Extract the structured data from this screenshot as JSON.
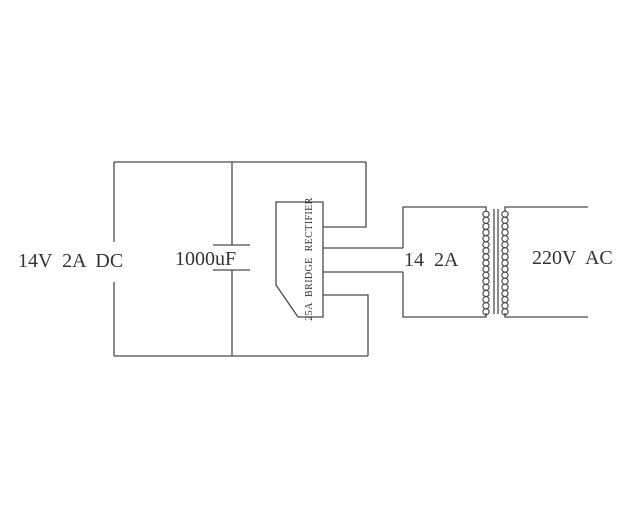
{
  "diagram": {
    "type": "circuit-schematic",
    "description": "DC power supply schematic: 220V AC mains into transformer, bridge rectifier, filter capacitor, 14V 2A DC output",
    "labels": {
      "dc_output": "14V 2A DC",
      "capacitor": "1000uF",
      "rectifier": "25A BRIDGE RECTIFIER",
      "transformer_secondary": "14 2A",
      "ac_input": "220V AC"
    },
    "colors": {
      "line": "#4a4a4a",
      "text": "#333333",
      "background": "#ffffff"
    }
  }
}
